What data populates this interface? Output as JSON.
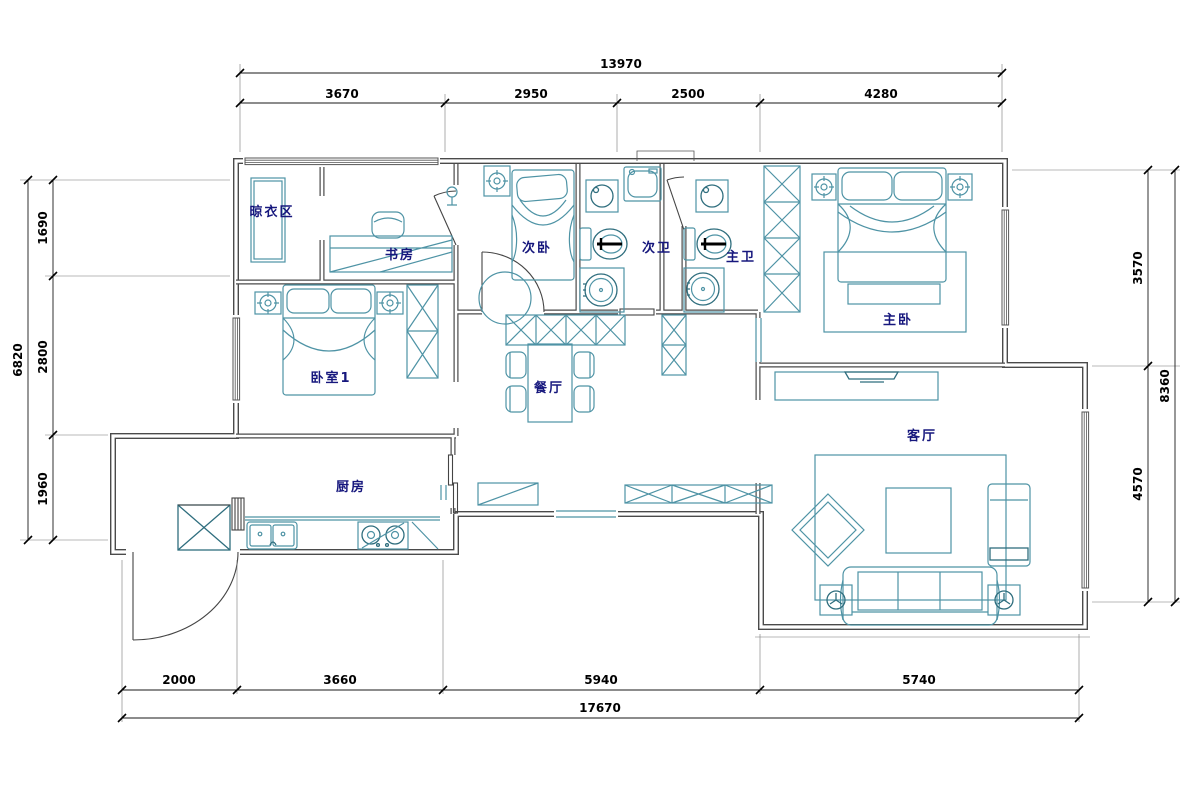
{
  "plan": {
    "rooms": [
      {
        "id": "drying-area",
        "label": "晾衣区"
      },
      {
        "id": "study",
        "label": "书房"
      },
      {
        "id": "bedroom-2",
        "label": "次卧"
      },
      {
        "id": "bath-2",
        "label": "次卫"
      },
      {
        "id": "bath-master",
        "label": "主卫"
      },
      {
        "id": "bedroom-master",
        "label": "主卧"
      },
      {
        "id": "bedroom-1",
        "label": "卧室1"
      },
      {
        "id": "dining",
        "label": "餐厅"
      },
      {
        "id": "kitchen",
        "label": "厨房"
      },
      {
        "id": "living",
        "label": "客厅"
      }
    ],
    "dimensions": {
      "top": {
        "total": "13970",
        "segments": [
          "3670",
          "2950",
          "2500",
          "4280"
        ]
      },
      "left": {
        "total": "6820",
        "segments": [
          "1690",
          "2800",
          "1960"
        ]
      },
      "right": {
        "total": "8360",
        "segments": [
          "3570",
          "4570"
        ]
      },
      "bottom": {
        "total": "17670",
        "segments": [
          "2000",
          "3660",
          "5940",
          "5740"
        ]
      }
    },
    "colors": {
      "wall": "#4a4a4a",
      "furniture": "#4e93a5",
      "label": "#16177d",
      "dimension": "#000000"
    }
  }
}
